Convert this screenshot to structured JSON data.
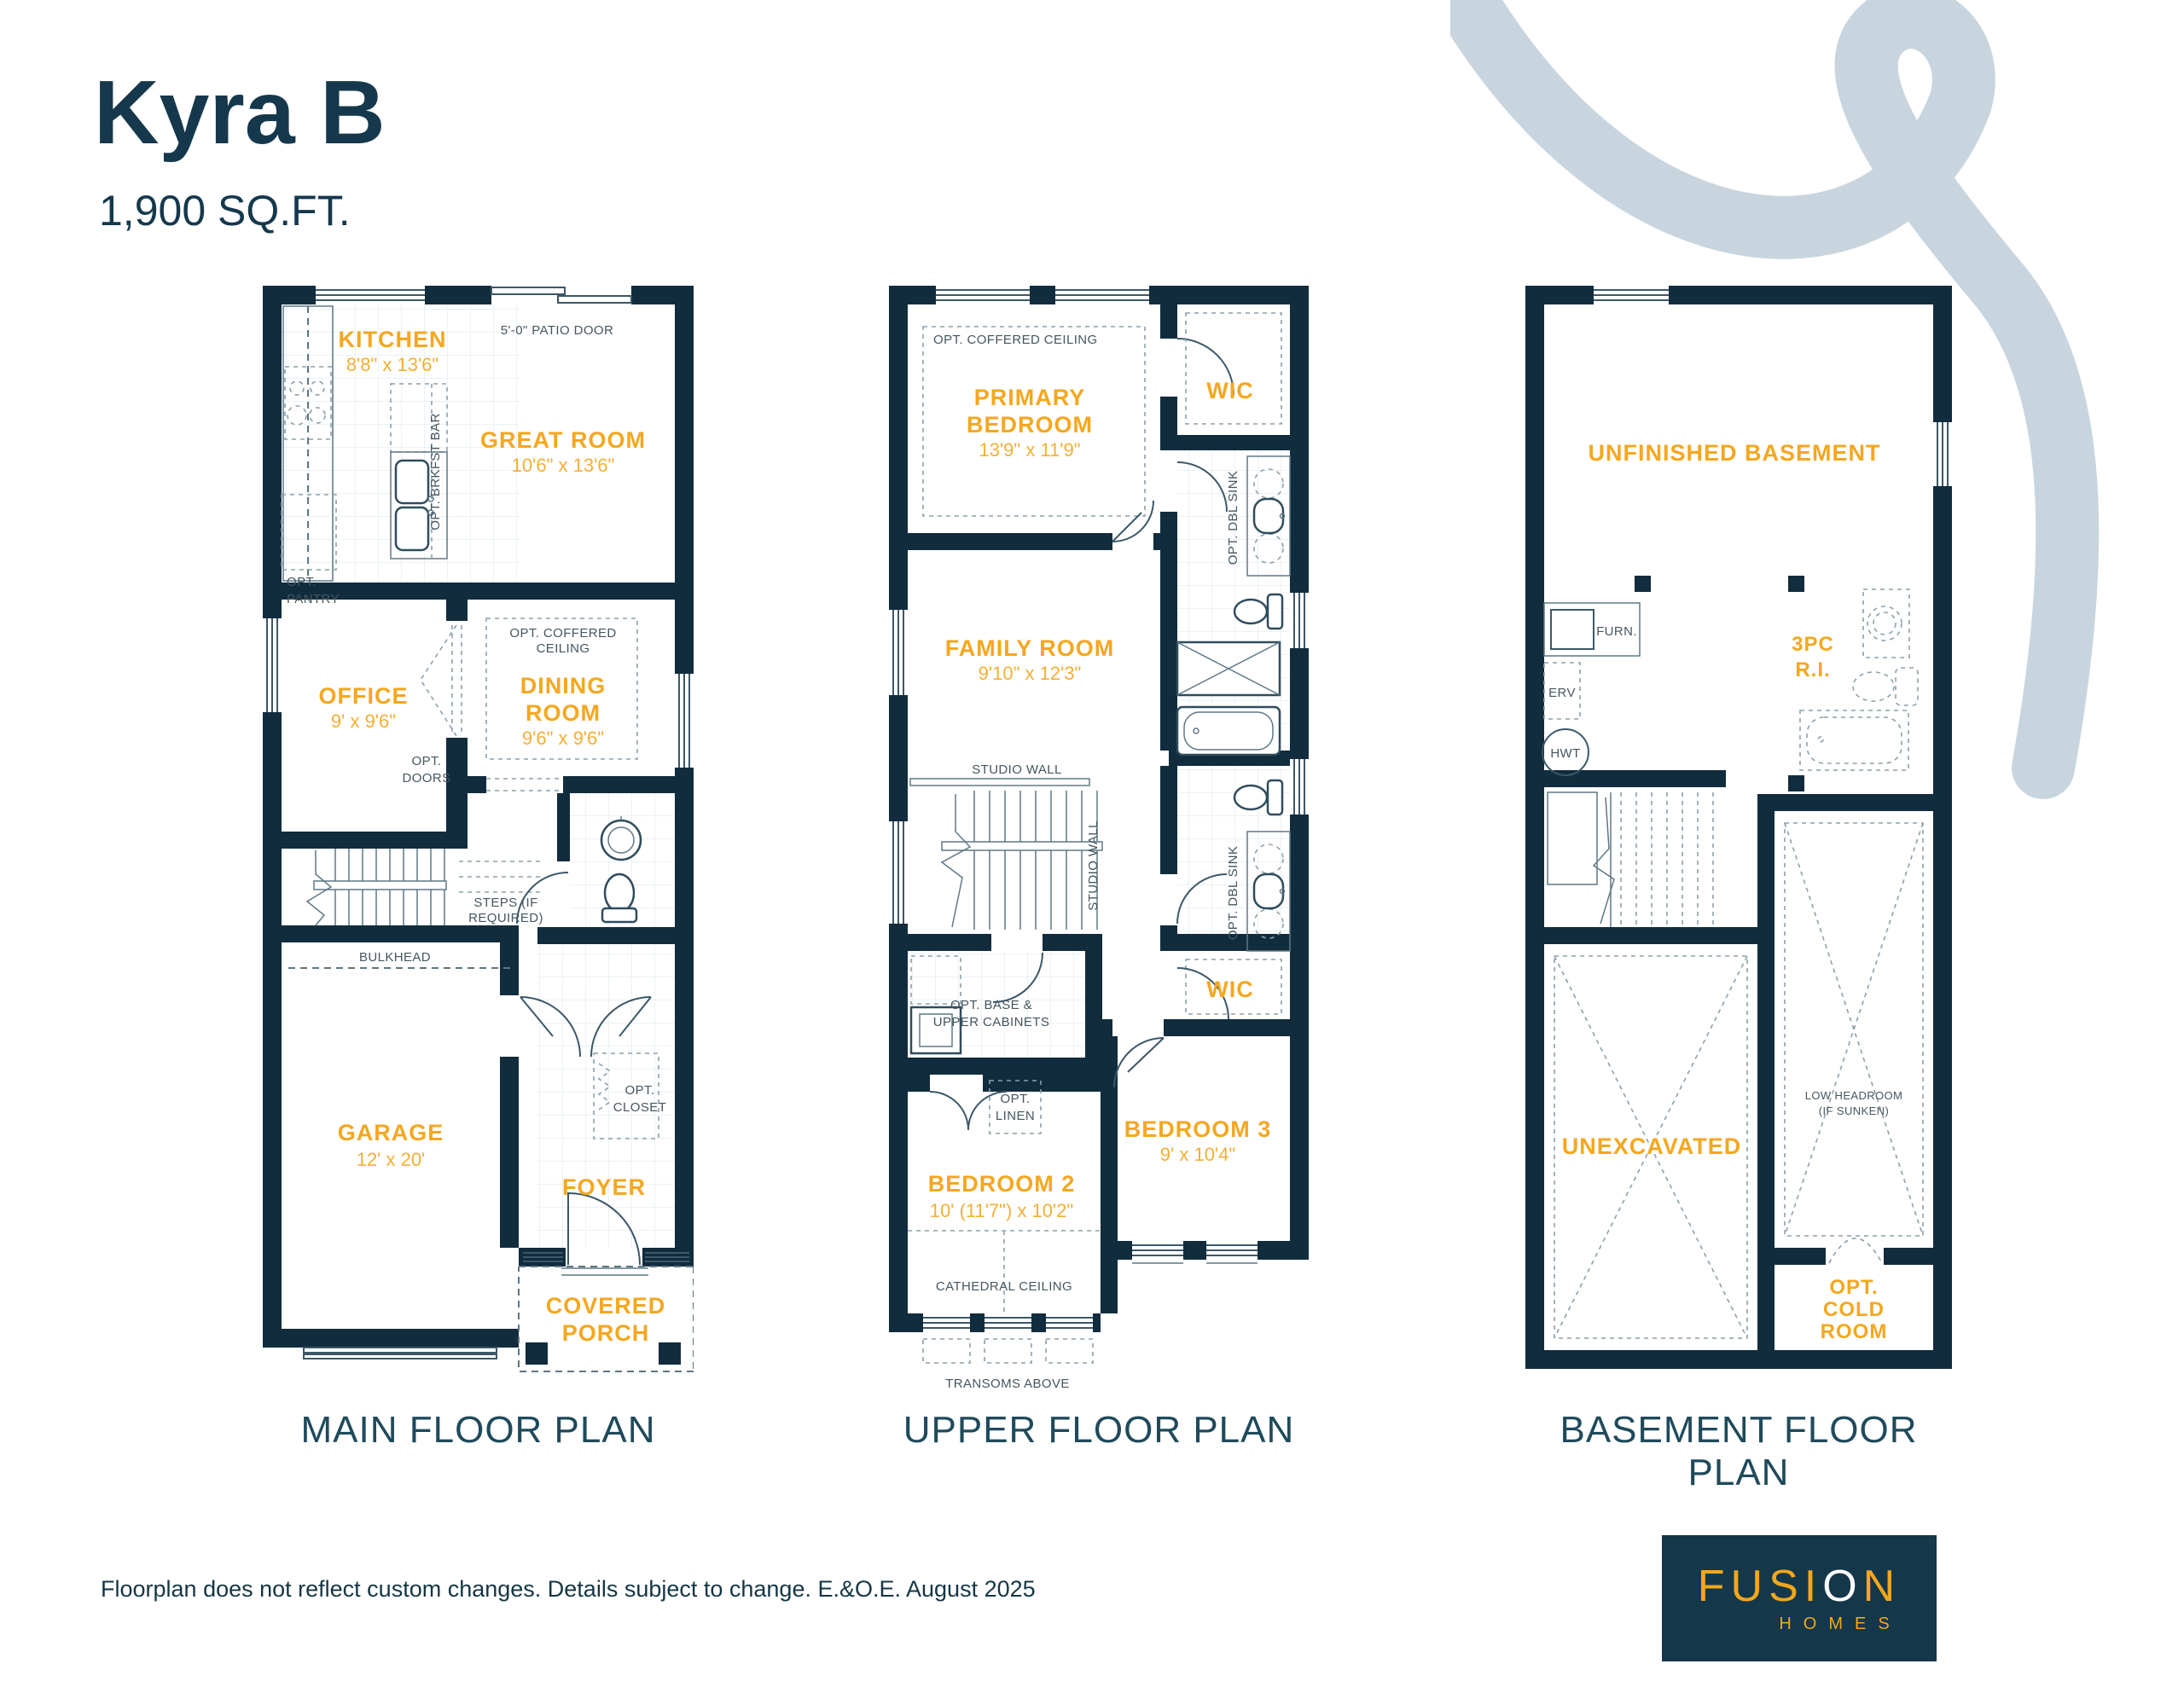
{
  "header": {
    "title": "Kyra B",
    "sqft": "1,900 SQ.FT."
  },
  "colors": {
    "navy": "#112C3D",
    "gold": "#F5A71F",
    "ribbon": "#C8D5DE",
    "logo_bg": "#14374A"
  },
  "plans": {
    "main": {
      "caption": "MAIN FLOOR PLAN",
      "kitchen": {
        "name": "KITCHEN",
        "dims": "8'8\" x 13'6\""
      },
      "great_room": {
        "name": "GREAT ROOM",
        "dims": "10'6\" x 13'6\""
      },
      "office": {
        "name": "OFFICE",
        "dims": "9' x 9'6\""
      },
      "dining_room": {
        "name_l1": "DINING",
        "name_l2": "ROOM",
        "dims": "9'6\" x 9'6\""
      },
      "garage": {
        "name": "GARAGE",
        "dims": "12' x 20'"
      },
      "foyer": {
        "name": "FOYER"
      },
      "covered_porch": {
        "name_l1": "COVERED",
        "name_l2": "PORCH"
      },
      "notes": {
        "patio_door": "5'-0\" PATIO DOOR",
        "opt_brkfst_bar": "OPT. BRKFST BAR",
        "opt_pantry_l1": "OPT.",
        "opt_pantry_l2": "PANTRY",
        "opt_coffered_l1": "OPT. COFFERED",
        "opt_coffered_l2": "CEILING",
        "opt_doors_l1": "OPT.",
        "opt_doors_l2": "DOORS",
        "steps_l1": "STEPS (IF",
        "steps_l2": "REQUIRED)",
        "bulkhead": "BULKHEAD",
        "opt_closet_l1": "OPT.",
        "opt_closet_l2": "CLOSET"
      }
    },
    "upper": {
      "caption": "UPPER FLOOR PLAN",
      "primary_bedroom": {
        "name_l1": "PRIMARY",
        "name_l2": "BEDROOM",
        "dims": "13'9\" x 11'9\""
      },
      "wic1": {
        "name": "WIC"
      },
      "wic2": {
        "name": "WIC"
      },
      "family_room": {
        "name": "FAMILY ROOM",
        "dims": "9'10\" x 12'3\""
      },
      "bedroom2": {
        "name": "BEDROOM 2",
        "dims": "10' (11'7\") x 10'2\""
      },
      "bedroom3": {
        "name": "BEDROOM 3",
        "dims": "9' x 10'4\""
      },
      "notes": {
        "opt_coffered": "OPT. COFFERED CEILING",
        "opt_dbl_sink": "OPT. DBL SINK",
        "studio_wall": "STUDIO WALL",
        "opt_base_l1": "OPT. BASE &",
        "opt_base_l2": "UPPER CABINETS",
        "opt_linen_l1": "OPT.",
        "opt_linen_l2": "LINEN",
        "cathedral": "CATHEDRAL CEILING",
        "transoms": "TRANSOMS ABOVE"
      }
    },
    "basement": {
      "caption": "BASEMENT FLOOR PLAN",
      "unfinished": {
        "name": "UNFINISHED BASEMENT"
      },
      "threepc": {
        "name_l1": "3PC",
        "name_l2": "R.I."
      },
      "unexcavated": {
        "name": "UNEXCAVATED"
      },
      "cold_room": {
        "name_l1": "OPT.",
        "name_l2": "COLD",
        "name_l3": "ROOM"
      },
      "notes": {
        "furn": "FURN.",
        "erv": "ERV",
        "hwt": "HWT",
        "low_headroom_l1": "LOW HEADROOM",
        "low_headroom_l2": "(IF SUNKEN)"
      }
    }
  },
  "footer": {
    "disclaimer": "Floorplan does not reflect custom changes. Details subject to change. E.&O.E. August 2025"
  },
  "logo": {
    "brand_pre": "FUSI",
    "brand_o": "O",
    "brand_post": "N",
    "sub": "HOMES"
  }
}
